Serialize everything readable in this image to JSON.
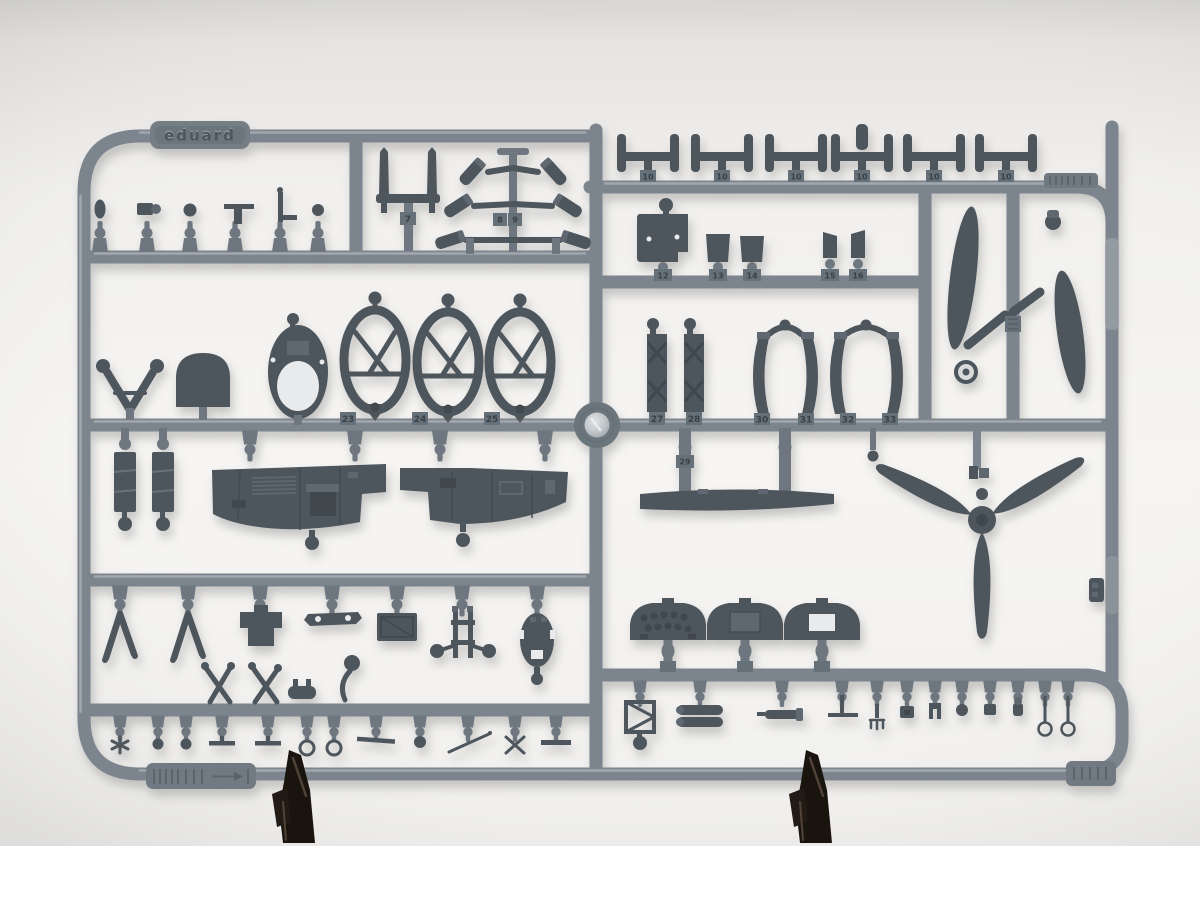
{
  "scene": {
    "type": "photograph",
    "subject": "Gray injection-molded plastic model kit sprue (parts tree) photographed against a white studio background, held upright by two black clip stands at the bottom rail",
    "brand_embossed": "eduard"
  },
  "sprue": {
    "brand_plate": "eduard",
    "part_number_tabs": {
      "t7": "7",
      "t8": "8",
      "t9": "9",
      "t10": "10",
      "t12": "12",
      "t13": "13",
      "t14": "14",
      "t15": "15",
      "t16": "16",
      "t23": "23",
      "t24": "24",
      "t25": "25",
      "t27": "27",
      "t28": "28",
      "t29": "29",
      "t30": "30",
      "t31": "31",
      "t32": "32",
      "t33": "33"
    },
    "depicted_parts": [
      "antenna masts",
      "exhaust stack cluster",
      "gun barrel T-pieces",
      "control yoke",
      "head armor dome",
      "fuselage bulkhead frames",
      "cockpit sidewall panels",
      "seat",
      "equipment boxes",
      "gunsight",
      "instrument panels",
      "three-blade propeller",
      "single propeller blades with hub crescents",
      "curved cowl straps",
      "drop tanks",
      "levers, rings and small fittings"
    ]
  },
  "colors": {
    "bg-top": "#d8d7d5",
    "bg": "#f3f2f0",
    "photo-white": "#ffffff",
    "rail": "#7c858e",
    "rail-dark": "#68717a",
    "gate": "#6e7780",
    "tab": "#657078",
    "part": "#4d555d",
    "part-light": "#5f6870",
    "part-dark": "#3f474e",
    "hole": "#e8eaeb",
    "boss-shine": "#cdd1d4",
    "clamp": "#1a140f",
    "clamp-highlight": "#5d4e41"
  }
}
